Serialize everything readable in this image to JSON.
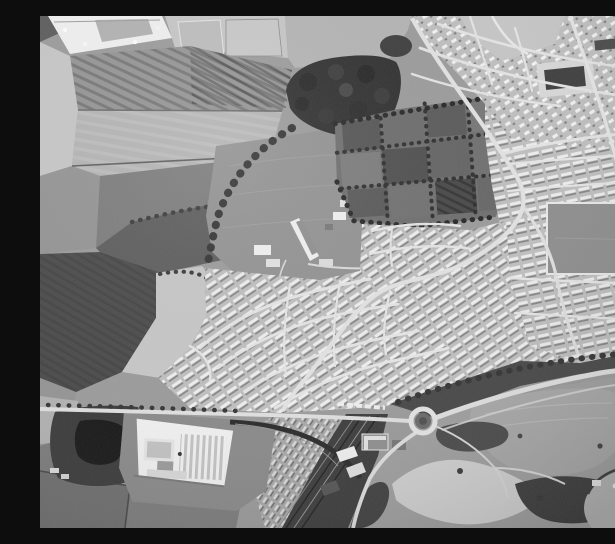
{
  "image": {
    "type": "monochrome-vertical-aerial-photograph",
    "alt": "Black-and-white vertical aerial photograph of a town edge: ploughed farmland and a housing construction site to the north-west, a dark woodland belt and a school with large playing fields in the centre, a grid of allotment gardens, dense suburban housing estates filling the east, an east-west road leading to a roundabout with a bypass curving north-east, a white factory complex with saw-tooth roofing, a dark pond among trees, railway sidings running to the bottom edge, and rough open ground with sandy tracks and a smooth oval enclosure in the south-east."
  },
  "palette": {
    "photo-bg": "#9b9b9b",
    "field-pale": "#c7c7c7",
    "field-light": "#b4b4b4",
    "field-mid": "#949494",
    "field-dim": "#7c7c7c",
    "field-dark": "#5c5c5c",
    "field-plow": "#4a4a4a",
    "woodland": "#2e2e2e",
    "pond": "#171717",
    "housing-base": "#bfbfbf",
    "house-white": "#ededed",
    "road": "#e2e2e2",
    "rail-dark": "#3c3c3c",
    "building-white": "#f1f1f1",
    "scrub": "#424242",
    "sand": "#d8d8d8",
    "open-ground": "#a0a0a0",
    "band": "#474747",
    "school-field": "#929292"
  },
  "regions": [
    {
      "name": "construction-site",
      "label": "new estate under construction (top-left)"
    },
    {
      "name": "striped-fields",
      "label": "ploughed striped fields (upper-left)"
    },
    {
      "name": "woodland",
      "label": "dark woodland belt (top-centre)"
    },
    {
      "name": "school-grounds",
      "label": "school buildings and playing fields (centre)"
    },
    {
      "name": "allotments",
      "label": "allotment garden grid (centre)"
    },
    {
      "name": "housing-north",
      "label": "suburban housing, north strip"
    },
    {
      "name": "housing-east",
      "label": "dense terraced housing, east"
    },
    {
      "name": "housing-centre",
      "label": "curved-street housing estate, centre"
    },
    {
      "name": "recreation-ground",
      "label": "rectangular playing field within housing (right)"
    },
    {
      "name": "main-road",
      "label": "main road descending from top edge"
    },
    {
      "name": "east-west-road",
      "label": "east-west road across lower photo"
    },
    {
      "name": "roundabout",
      "label": "roundabout junction (lower-centre)"
    },
    {
      "name": "bypass-road",
      "label": "bypass curving to right edge"
    },
    {
      "name": "factory",
      "label": "white factory with saw-tooth roof (lower-left)"
    },
    {
      "name": "pond",
      "label": "dark pond among trees (lower-left)"
    },
    {
      "name": "railway-corridor",
      "label": "railway lines and sidings (bottom-centre)"
    },
    {
      "name": "open-ground",
      "label": "rough open ground, sandy tracks (bottom-right)"
    },
    {
      "name": "oval-enclosure",
      "label": "smooth oval enclosure (bottom-right corner)"
    }
  ]
}
